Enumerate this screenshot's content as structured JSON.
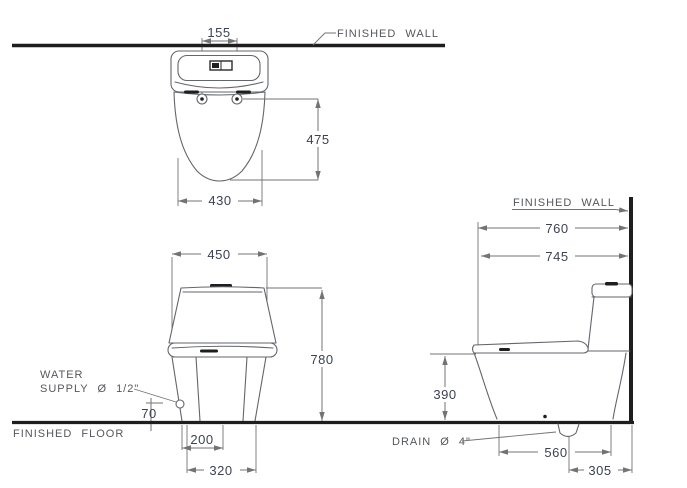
{
  "colors": {
    "background": "#ffffff",
    "structure_line": "#1e1e1e",
    "fixture_line": "#63666b",
    "dimension_line": "#737373",
    "label_text": "#54575c",
    "number_text": "#3c4254"
  },
  "labels": {
    "finished_wall_top": "FINISHED WALL",
    "finished_wall_right": "FINISHED WALL",
    "finished_floor": "FINISHED FLOOR",
    "water_supply_line1": "WATER",
    "water_supply_line2": "SUPPLY Ø 1/2\"",
    "drain": "DRAIN Ø 4\""
  },
  "views": {
    "top_view": {
      "dims": {
        "bolt_spacing": "155",
        "depth_to_front": "475",
        "width": "430"
      }
    },
    "front_view": {
      "dims": {
        "width": "450",
        "height": "780",
        "supply_height": "70",
        "trap_width": "200",
        "base_width": "320"
      }
    },
    "side_view": {
      "dims": {
        "depth": "760",
        "depth_to_seat": "745",
        "bowl_height": "390",
        "base_depth": "560",
        "drain_set_out": "305"
      }
    }
  }
}
